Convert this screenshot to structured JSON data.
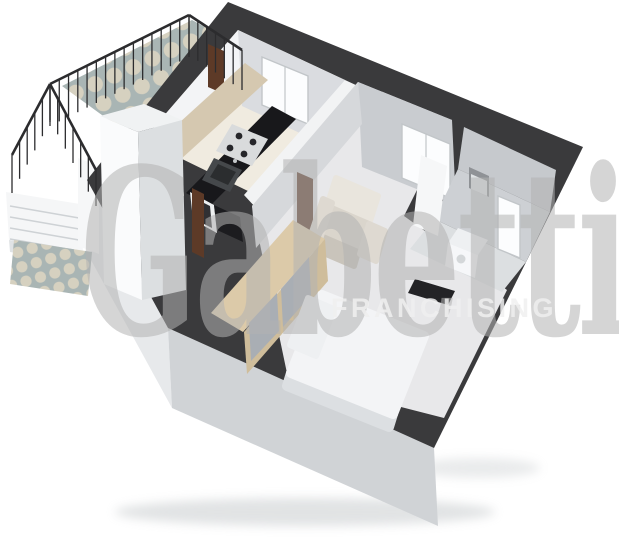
{
  "watermark": {
    "brand": "Gabetti",
    "subtitle": "FRANCHISING"
  },
  "scene": {
    "type": "3d-floorplan-render",
    "rooms": [
      "balcony",
      "kitchen",
      "hallway",
      "living-room",
      "bathroom",
      "sleeping-area"
    ],
    "furniture": [
      "bar-counter",
      "kitchen-counter",
      "stove",
      "sink",
      "wardrobe",
      "armchair",
      "double-bed",
      "tv-panel",
      "washing-machine",
      "wall-niche",
      "stairs",
      "railing",
      "column"
    ]
  },
  "colors": {
    "background": "#ffffff",
    "wall_dark": "#3a3a3c",
    "ext_left": "#e7e9eb",
    "ext_front": "#d0d3d6",
    "kitchen_floor": "#f0ebe0",
    "hallway_floor": "#f2f3f4",
    "living_floor": "#e8e8ea",
    "bath_wall_ne": "#c6c9cd",
    "bath_wall_nw": "#cdd0d4",
    "bath_floor": "#dcdfe1",
    "living_wall_ne": "#c9ccd0",
    "living_wall_nw": "#d6d8db",
    "kitchen_wall_nw": "#f3f4f6",
    "kitchen_wall_ne": "#dadce0",
    "window_white": "#fcfdfe",
    "door_brown": "#5d3a27",
    "door_white": "#f6f7f8",
    "bar_top": "#d5c8b0",
    "bar_end": "#e4dac7",
    "counter_black": "#18181b",
    "stove_steel": "#d9dbdc",
    "burner_dark": "#26262a",
    "sink_dark": "#45484b",
    "sink_inner": "#2b2d2f",
    "steel": "#c5c8ca",
    "cabinet_white": "#edeff0",
    "cabinet_inset": "#303033",
    "counter_front_dark": "#1c1c1f",
    "wood_top": "#dccaa9",
    "wood_front": "#cfbd9b",
    "wood_panel": "#a9aeb4",
    "chair_back": "#e9e5dd",
    "chair_seat": "#dad5cc",
    "chair_base": "#c9c4bb",
    "chair_arm": "#ded9d1",
    "bed_duvet": "#f3f4f6",
    "bed_side": "#dcdfe2",
    "bed_pillow": "#eef0f2",
    "tv_dark": "#232326",
    "appliance_top": "#eef0f2",
    "appliance_front": "#f6f7f9",
    "appliance_door": "#d4d7d9",
    "niche_dark": "#8f9296",
    "niche_inner": "#dfe2e4",
    "column_top": "#f0f2f3",
    "column_left": "#fafbfc",
    "column_right": "#dcdfe1",
    "railing": "#2c2c2e",
    "tile_base": "#a9b5b4",
    "tile_circle": "#d6d1c0",
    "stair_white": "#f5f6f7",
    "stair_face": "#e0e3e5",
    "stair_tread": "#ced2d5",
    "shadow": "#aab0b4",
    "watermark_serif": "#b3b3b3",
    "watermark_sans": "#f0f0f0"
  }
}
